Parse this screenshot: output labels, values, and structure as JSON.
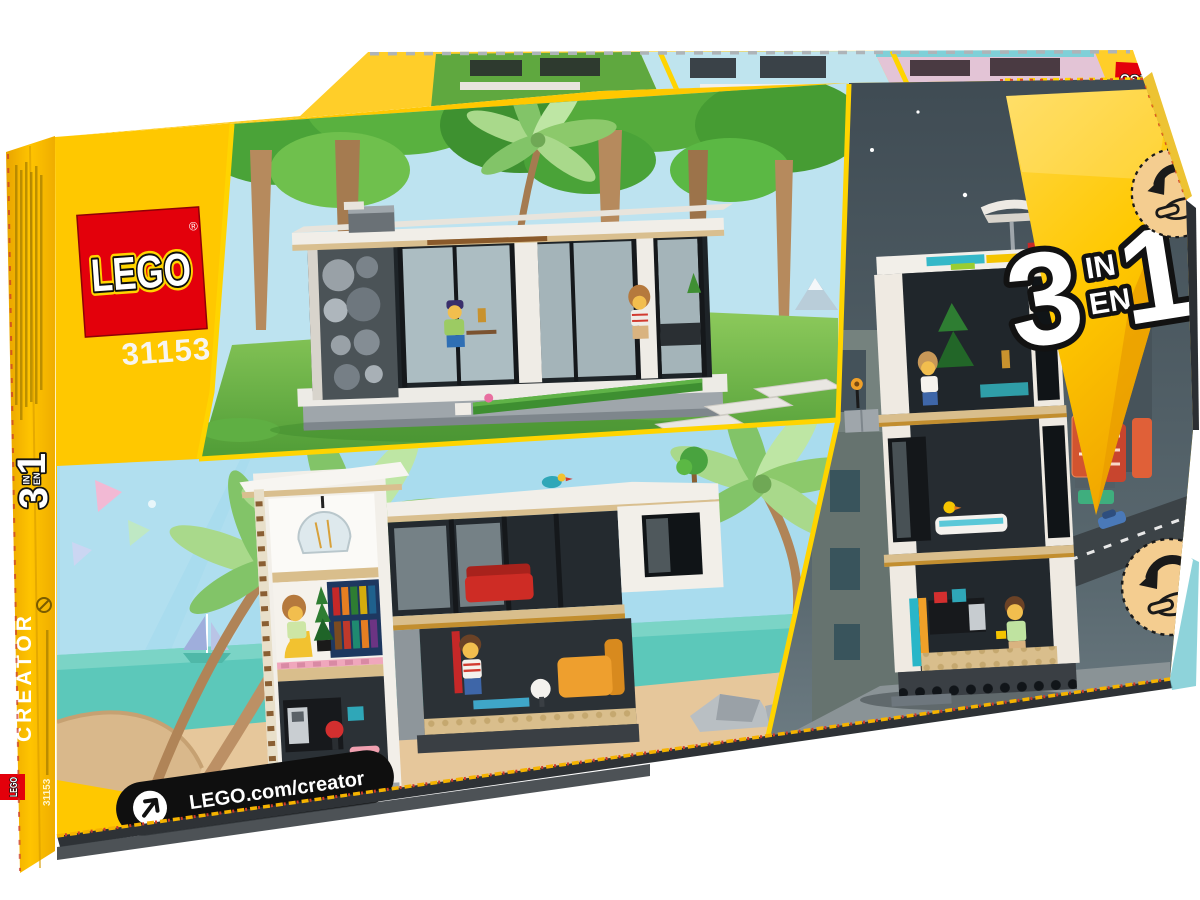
{
  "brand": {
    "logo_text": "LEGO",
    "registered_mark": "®"
  },
  "set": {
    "number": "31153",
    "theme_label": "CREATOR"
  },
  "badge_3in1": {
    "left_digit": "3",
    "top_word": "IN",
    "bottom_word": "EN",
    "right_digit": "1"
  },
  "footer": {
    "url_label": "LEGO.com/creator"
  },
  "icons": {
    "url_arrow": "arrow-up-right-icon",
    "flip_gesture_top": "rotate-hand-icon",
    "flip_gesture_bottom": "rotate-hand-icon",
    "age_warning": "choking-hazard-icon"
  },
  "colors": {
    "lego_red": "#E3000B",
    "box_yellow": "#FFC800",
    "divider_yellow": "#FFD400",
    "flap_yellow": "#FFCE29",
    "side_yellow": "#F0AF00",
    "badge_yellow_light": "#FFD84A",
    "badge_yellow_deep": "#F2A900",
    "night_sky_top": "#3F4B53",
    "night_sky_bottom": "#6E7D84",
    "beach_sky": "#A9DCEE",
    "sea_teal": "#5CC8BA",
    "sand": "#E6C79B",
    "grass_light": "#8CC95B",
    "grass_dark": "#4F9C36",
    "canopy_green": "#4AA338",
    "trunk_brown": "#B68A5D",
    "house_white": "#F2EFE9",
    "wood_tan": "#D9BE8C",
    "frame_dark": "#15181B",
    "pill_black": "#0F0F0F"
  }
}
